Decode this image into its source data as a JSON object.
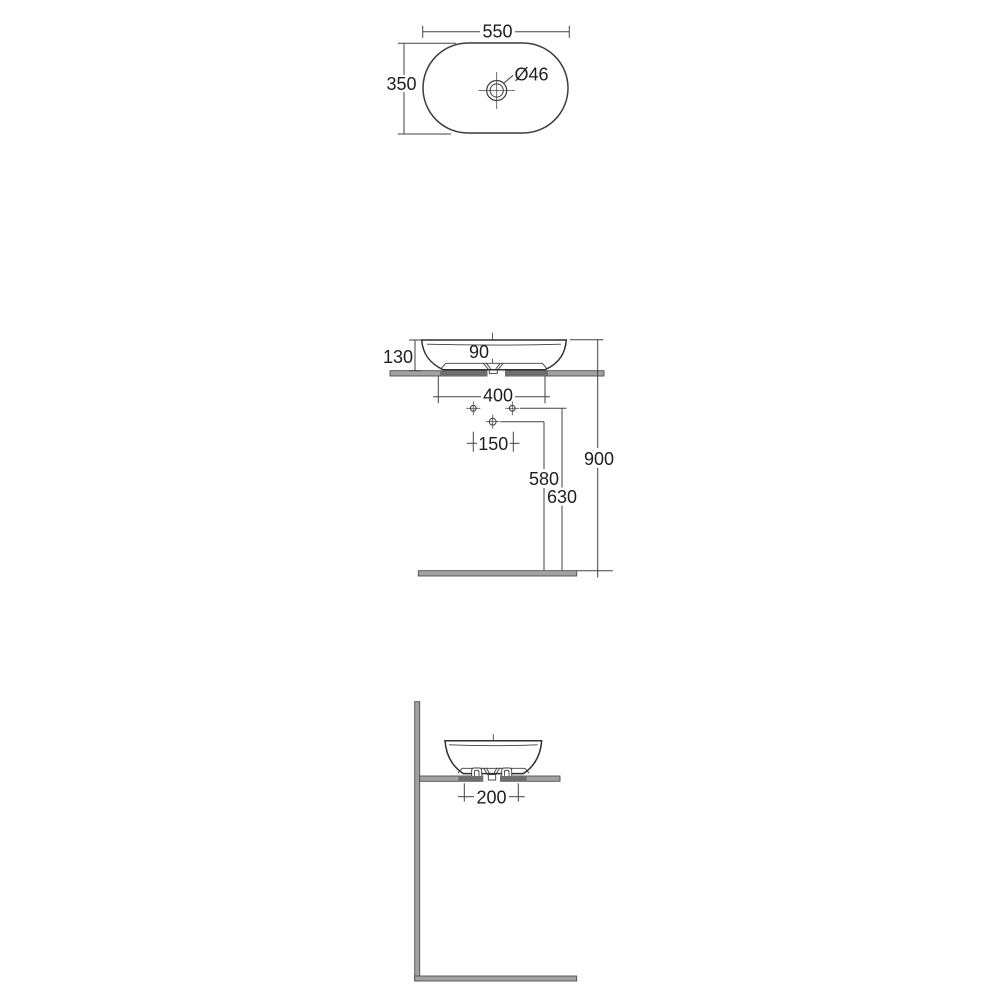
{
  "colors": {
    "line": "#3c3c3c",
    "dim_line": "#424242",
    "text": "#1e1e1e",
    "surface_fill": "#a2a2a2",
    "surface_border": "#4e4e4e",
    "surface_dark": "#6e6e6e",
    "background": "#ffffff"
  },
  "top_view": {
    "dim_width": "550",
    "dim_depth": "350",
    "drain_label": "Ø46"
  },
  "front_view": {
    "dim_basin_height": "130",
    "dim_drain": "90",
    "dim_hole_span": "400",
    "dim_hole_pitch": "150",
    "dim_trap_height": "580",
    "dim_holes_height": "630",
    "dim_rim_height": "900"
  },
  "side_view": {
    "dim_ledge_offset": "200"
  }
}
